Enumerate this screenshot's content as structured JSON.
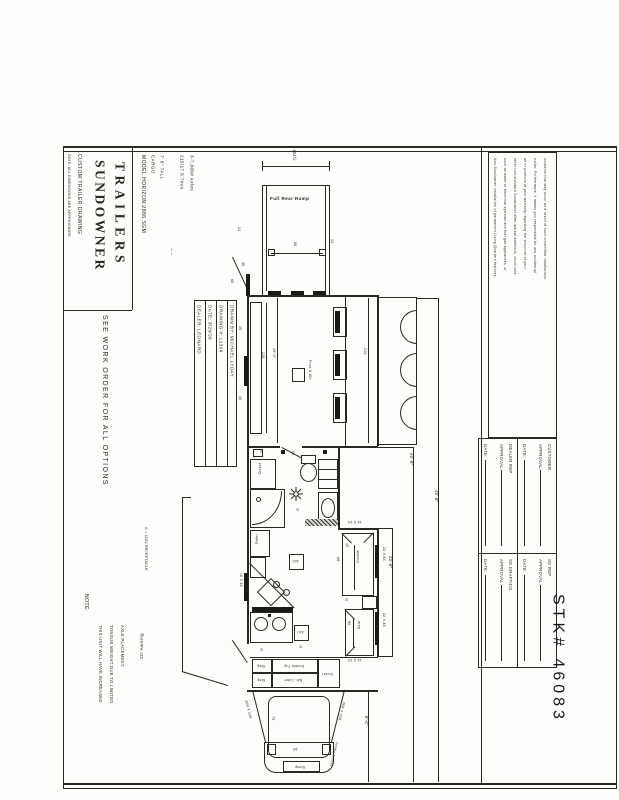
{
  "page": {
    "ink": "#2b2722",
    "paper": "#fdfdfc"
  },
  "title_block": {
    "brand_line1": "SUNDOWNER",
    "brand_line2": "TRAILERS",
    "subtitle": "CUSTOM TRAILER DRAWING",
    "note_small": "NOTE: ALL DIMENSIONS ARE APPROXIMATE",
    "model_line": "MODEL HORIZON 2886 SGM",
    "see_work_order": "SEE WORK ORDER FOR ALL OPTIONS",
    "spec_cargo": "CARGO",
    "spec_tall": "7' 8\" TALL",
    "spec_blank": "– –",
    "spec_tires": "215/17.5 Tires",
    "spec_axles": "3-7,000# Axles",
    "table": {
      "dealer": "DEALER: LEONARD",
      "date": "DATE: 3/20/26",
      "drawing_no": "DRAWING #: L1314",
      "drawn_by": "DRAWN BY: MICHAEL LYDAY"
    }
  },
  "legend": {
    "receptacle": "⊙ = 110V RECEPTACLE",
    "receptacle_symbol": "⊙"
  },
  "note_block": {
    "heading": "NOTE:",
    "line1": "THIS UNIT WILL HAVE INCREASED",
    "line2": "TONGUE WEIGHT DUE TO LIMITED",
    "line3": "AXLE PLACEMENT."
  },
  "awning_label": "20' Awning",
  "stk_number": "STK# 46083",
  "disclaimer_lines": [
    "Non-Sundowner installation of permanent Living Quarters features,",
    "such as water or electrical systems and fuel gas appliances, or",
    "other non-standard Sundowner after-market additions, could void",
    "all or portions of your warranty regarding the structure of your",
    "trailer. Furthermore, it makes you responsible for any accidental",
    "incidents that may occur as a result of such uncertified installations."
  ],
  "approvals": {
    "customer": {
      "who": "CUSTOMER",
      "approval": "APPROVAL:",
      "date": "DATE:"
    },
    "dealer_rep": {
      "who": "DEALER REP",
      "approval": "APPROVAL:",
      "date": "DATE:"
    },
    "sd_rep": {
      "who": "SD REP",
      "approval": "APPROVAL:",
      "date": "DATE:"
    },
    "sd_drafting": {
      "who": "SD DRAFTING",
      "approval": "APPROVAL:",
      "date": "DATE:"
    }
  },
  "plan": {
    "ramp_label": "Full Rear Ramp",
    "ramp_dim": "104½",
    "rear": {
      "left12": "12",
      "right12": "12",
      "opening60": "60",
      "door36": "36",
      "door60": "60"
    },
    "cargo": {
      "win40a": "40",
      "win40b": "40",
      "counter228": "228",
      "len19": "19'-0\"",
      "fuse": "Fuse & Wtr",
      "fenders_dim": "240"
    },
    "bath": {
      "closet": "Closet",
      "door32": "32",
      "dim20": "20",
      "window1424": "14 X 24"
    },
    "kitchen": {
      "fridge": "Refer",
      "window1636": "16 X 36",
      "ac": "A/C"
    },
    "lq": {
      "dinette": "Dinette",
      "d40": "40",
      "d68": "68",
      "win2248": "22 X 48",
      "sofa": "Sofa",
      "s60": "60",
      "win1424": "14 X 24",
      "lq_len": "20'-8\""
    },
    "gooseneck": {
      "step": "Step",
      "double_top": "Double Top",
      "bal_cnter": "Bal. Cnter",
      "closet": "Closet",
      "bed75": "75",
      "bed60": "60",
      "slant_window": "36R X 22R",
      "jumbo": "Jumbo Access",
      "sump": "Sump",
      "gn_len": "8'-0\""
    },
    "overall": {
      "len1": "40'-8\"",
      "len2": "45'-8\""
    }
  }
}
